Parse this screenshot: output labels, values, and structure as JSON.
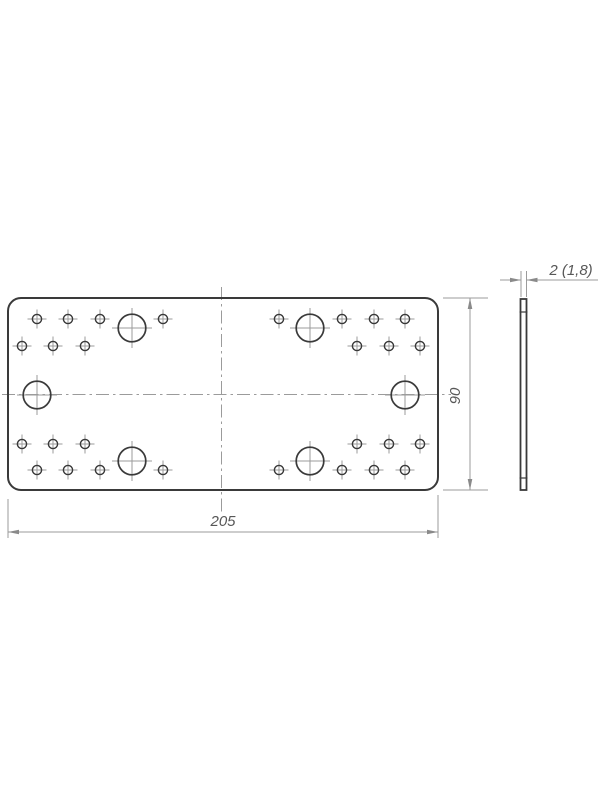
{
  "drawing": {
    "type": "technical-drawing",
    "subject": "flat-connector-plate",
    "views": {
      "front_view": {
        "plate": {
          "x": 8,
          "y": 298,
          "width": 430,
          "height": 192,
          "corner_radius": 13
        },
        "small_hole_radius": 4.6,
        "large_hole_radius": 13.8,
        "small_holes": [
          [
            37,
            319
          ],
          [
            68,
            319
          ],
          [
            100,
            319
          ],
          [
            163,
            319
          ],
          [
            279,
            319
          ],
          [
            342,
            319
          ],
          [
            374,
            319
          ],
          [
            405,
            319
          ],
          [
            22,
            346
          ],
          [
            53,
            346
          ],
          [
            85,
            346
          ],
          [
            357,
            346
          ],
          [
            389,
            346
          ],
          [
            420,
            346
          ],
          [
            22,
            444
          ],
          [
            53,
            444
          ],
          [
            85,
            444
          ],
          [
            357,
            444
          ],
          [
            389,
            444
          ],
          [
            420,
            444
          ],
          [
            37,
            470
          ],
          [
            68,
            470
          ],
          [
            100,
            470
          ],
          [
            163,
            470
          ],
          [
            279,
            470
          ],
          [
            342,
            470
          ],
          [
            374,
            470
          ],
          [
            405,
            470
          ]
        ],
        "large_holes": [
          [
            132,
            328
          ],
          [
            310,
            328
          ],
          [
            37,
            395
          ],
          [
            405,
            395
          ],
          [
            132,
            461
          ],
          [
            310,
            461
          ]
        ],
        "centerlines": {
          "vertical": {
            "x": 221.5,
            "y1": 287,
            "y2": 512
          },
          "horizontal": {
            "y": 394.5,
            "x1": 2,
            "x2": 451
          }
        }
      },
      "side_view": {
        "x": 520.5,
        "y": 299,
        "width": 6,
        "height": 191,
        "edge_ticks_y": [
          312,
          478
        ]
      }
    },
    "dimensions": {
      "width": {
        "label": "205",
        "line": {
          "y": 532,
          "x1": 8,
          "x2": 438
        },
        "extensions": [
          [
            8,
            499,
            8,
            538
          ],
          [
            438,
            495,
            438,
            538
          ]
        ],
        "text_pos": [
          223,
          526
        ]
      },
      "height": {
        "label": "90",
        "line": {
          "x": 470,
          "y1": 298,
          "y2": 490
        },
        "extensions": [
          [
            443,
            298,
            488,
            298
          ],
          [
            443,
            490,
            488,
            490
          ]
        ],
        "text_pos": [
          460,
          396
        ]
      },
      "thickness": {
        "label": "2 (1,8)",
        "line_y": 280,
        "left_line": [
          500,
          521
        ],
        "right_line": [
          526.5,
          598
        ],
        "extensions": [
          [
            521,
            271,
            521,
            297
          ],
          [
            526.5,
            271,
            526.5,
            297
          ]
        ],
        "text_pos": [
          571,
          275
        ]
      }
    },
    "colors": {
      "outline": "#3a3a3a",
      "thin_line": "#9b9b9b",
      "arrow": "#8a8a8a",
      "text": "#575757",
      "background": "#ffffff"
    }
  }
}
